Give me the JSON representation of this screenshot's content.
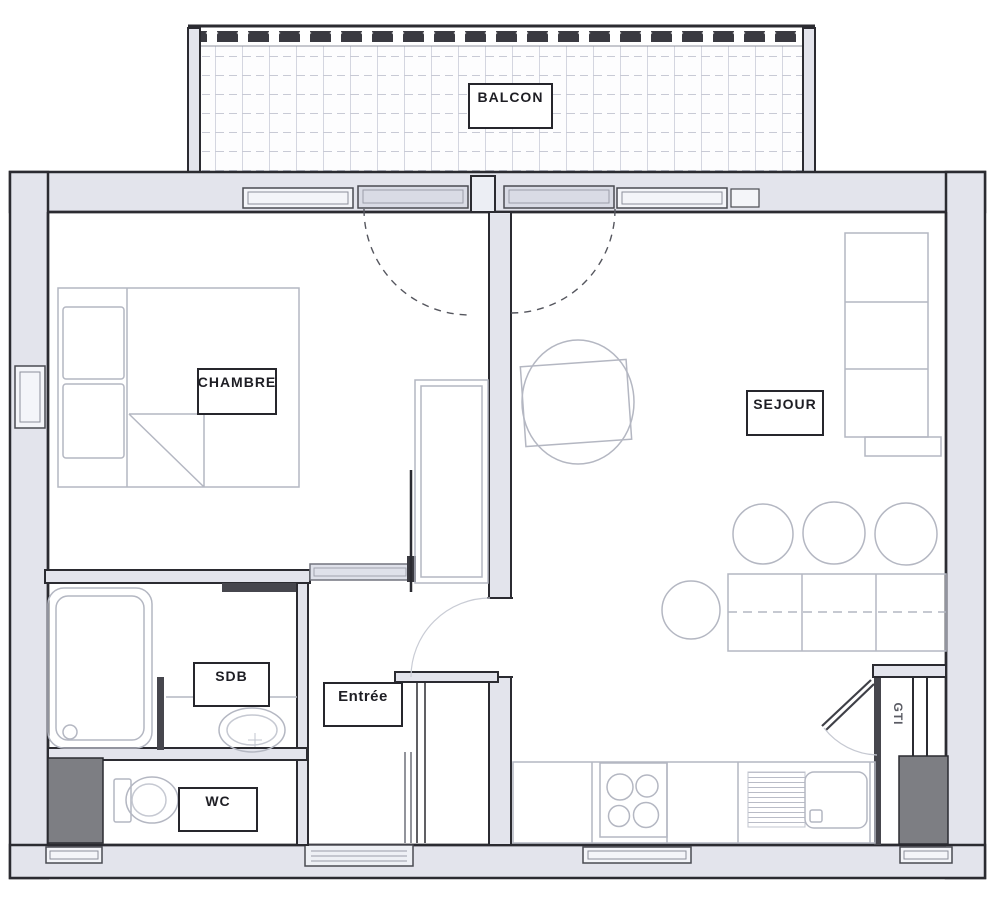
{
  "plan": {
    "type": "apartment-floor-plan",
    "labels": {
      "balcon": "BALCON",
      "chambre": "CHAMBRE",
      "sejour": "SEJOUR",
      "sdb": "SDB",
      "entree": "Entrée",
      "wc": "WC",
      "gti": "GTI"
    },
    "colors": {
      "wall_line": "#2b2b31",
      "wall_fill": "#e3e4ec",
      "furniture_line": "#b4b7c2",
      "duct_fill": "#7d7e83",
      "door_panel": "#dfe1ea",
      "background": "#ffffff"
    }
  }
}
